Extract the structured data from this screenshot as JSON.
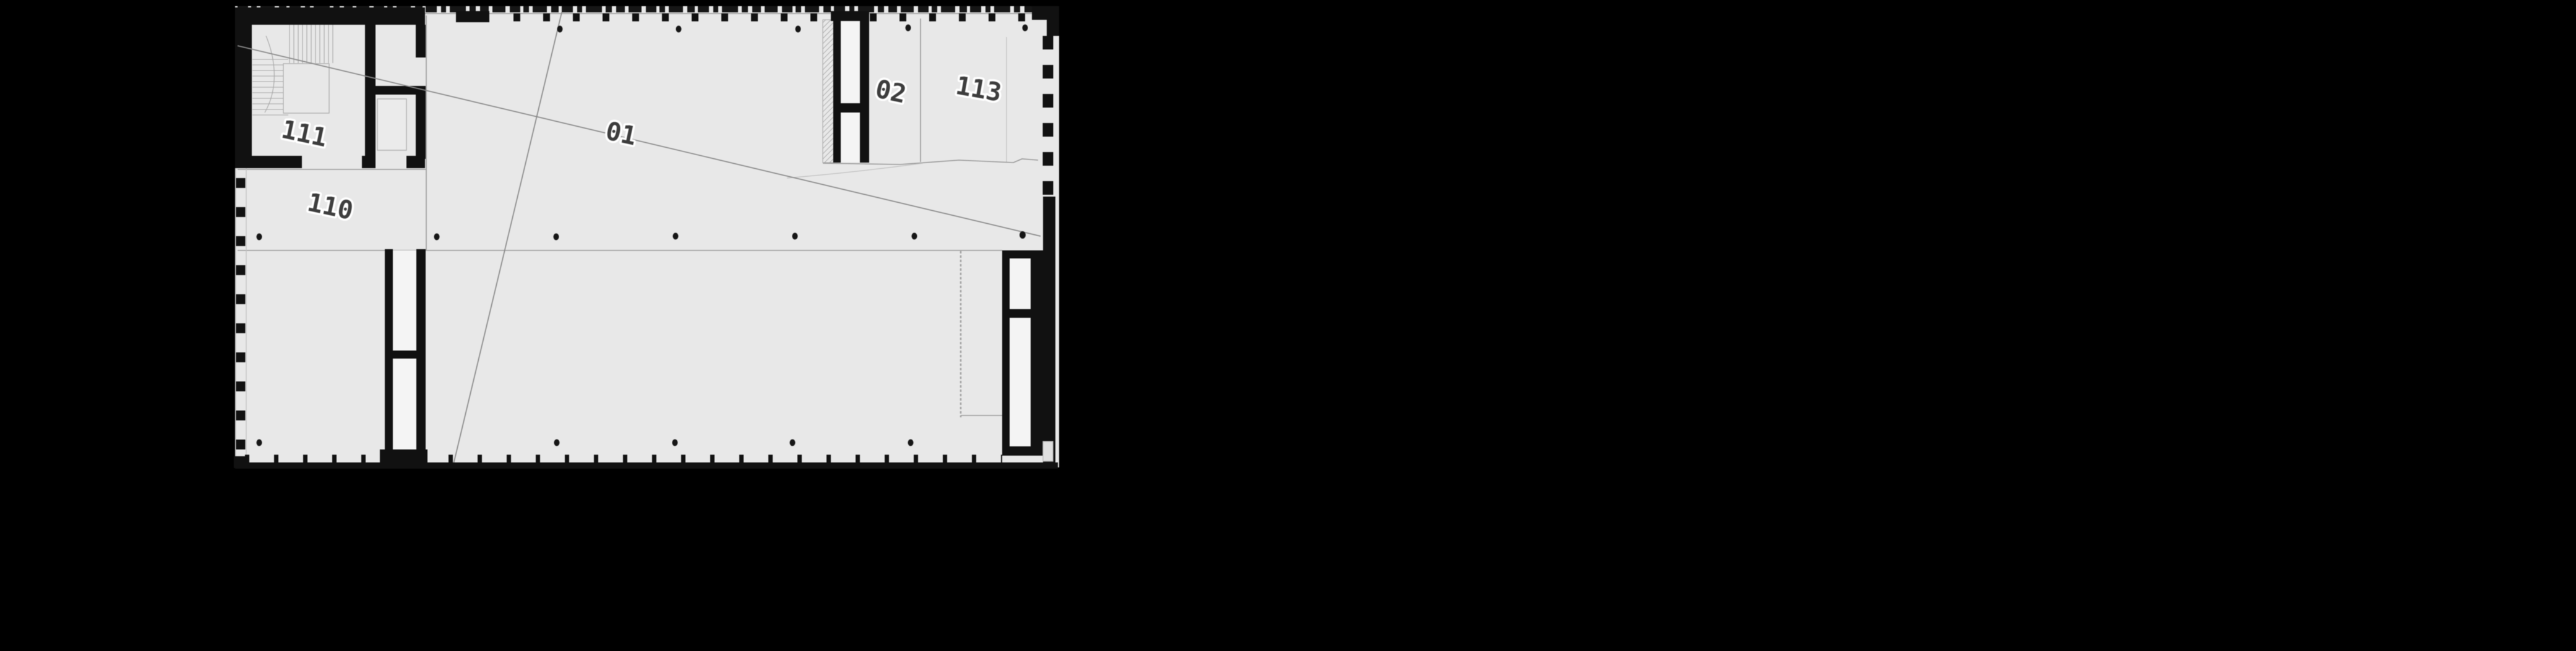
{
  "canvas": {
    "background": "#000000"
  },
  "floor_plan": {
    "room_labels": [
      {
        "id": "111",
        "text": "111"
      },
      {
        "id": "110",
        "text": "110"
      },
      {
        "id": "01",
        "text": "01"
      },
      {
        "id": "02",
        "text": "02"
      },
      {
        "id": "113",
        "text": "113"
      }
    ],
    "colors": {
      "background": "#000000",
      "floor": "#e8e8e8",
      "wall": "#111111",
      "core_interior": "#f4f4f4",
      "thin_line": "#9a9a9a",
      "label_text": "#3d3d3d",
      "label_halo": "#ffffff"
    }
  }
}
